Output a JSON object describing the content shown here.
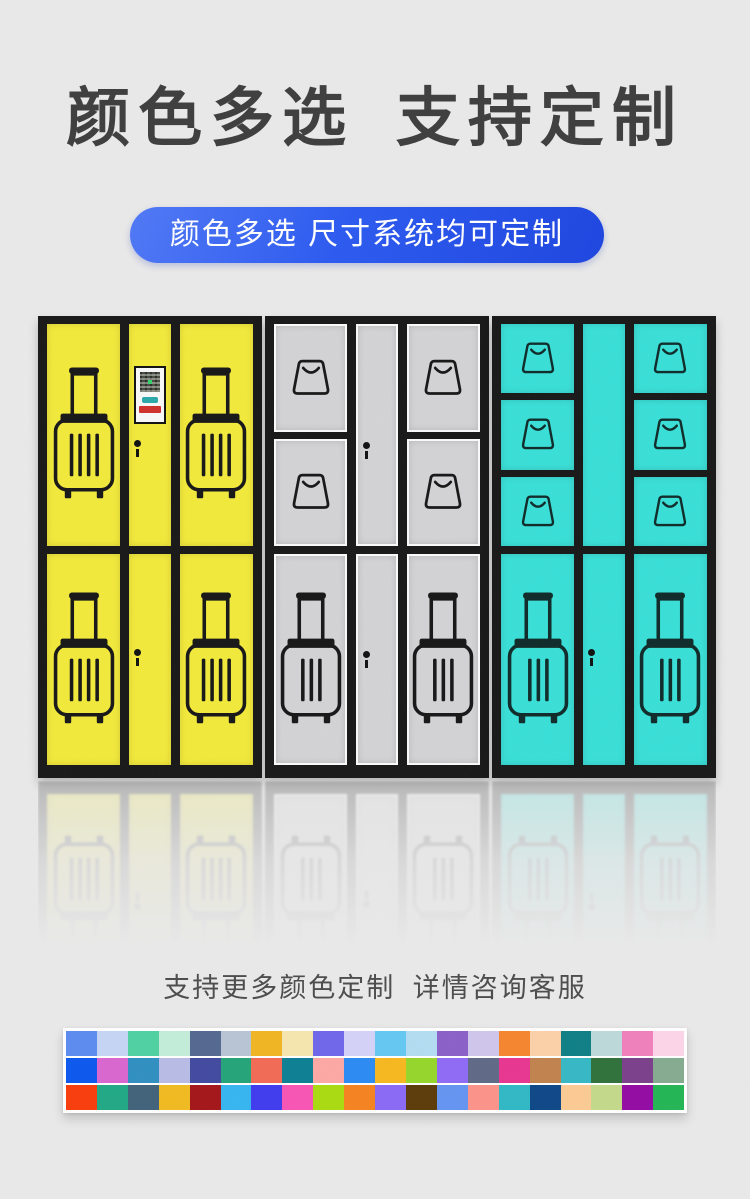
{
  "page": {
    "background_color": "#e9e9e9",
    "title": "颜色多选 支持定制",
    "title_color": "#3d3d3d",
    "banner": {
      "text": "颜色多选 尺寸系统均可定制",
      "bg_color": "#2b59f0",
      "text_color": "#ffffff"
    },
    "footer_note": "支持更多颜色定制 详情咨询客服"
  },
  "locker_frame_color": "#171717",
  "keyhole_color": "#101010",
  "screen": {
    "panel_bg": "#f8f8f8",
    "border_color": "#101010",
    "qr_icon": "qr-code",
    "qr_color": "#474c41",
    "teal_button_color": "#2aa8a8",
    "red_label_color": "#cf2f2c"
  },
  "lockers": [
    {
      "id": "yellow",
      "door_color": "#f2e93a",
      "icon_color": "#161616",
      "door_border": "",
      "top_compartments": 1,
      "top_icon": "luggage",
      "bottom_icon": "luggage",
      "luggage_slats": 4,
      "bag_size": 46,
      "has_screen": true,
      "keyhole_top": true,
      "keyhole_bottom": true
    },
    {
      "id": "gray",
      "door_color": "#d3d3d5",
      "icon_color": "#161616",
      "door_border": "#fafafa",
      "top_compartments": 2,
      "top_icon": "bag",
      "bottom_icon": "luggage",
      "luggage_slats": 3,
      "bag_size": 46,
      "has_screen": false,
      "keyhole_top": true,
      "keyhole_bottom": true
    },
    {
      "id": "cyan",
      "door_color": "#38dfd7",
      "icon_color": "#0e2a28",
      "door_border": "",
      "top_compartments": 3,
      "top_icon": "bag",
      "bottom_icon": "luggage",
      "luggage_slats": 3,
      "bag_size": 40,
      "has_screen": false,
      "keyhole_top": false,
      "keyhole_bottom": true
    }
  ],
  "palette": {
    "rows": [
      [
        "#5b8bf0",
        "#c5d5f4",
        "#4ed1a1",
        "#c2ecd9",
        "#53688f",
        "#b8c3d4",
        "#f0b521",
        "#f5e5ad",
        "#6f66ea",
        "#d4d2f7",
        "#63c8f2",
        "#b3dcf2",
        "#8a5fc8",
        "#cfc5ec",
        "#f5852e",
        "#fbd0a8",
        "#0d7f85",
        "#bcd9d9",
        "#f07fbc",
        "#fcd4e8"
      ],
      [
        "#0b57ee",
        "#d966cf",
        "#2f8fc0",
        "#b8bce5",
        "#41499f",
        "#23a378",
        "#f26a54",
        "#0c7f93",
        "#fda8a3",
        "#2b8af2",
        "#f7b81e",
        "#94d629",
        "#8f6af5",
        "#5f6986",
        "#e83590",
        "#c0824d",
        "#35b8c4",
        "#2f7039",
        "#7a3f8a",
        "#84ab8f"
      ],
      [
        "#f93c0c",
        "#20a884",
        "#41617a",
        "#f0ba1f",
        "#a31518",
        "#35b5f0",
        "#3f3aee",
        "#f854b5",
        "#aadb0f",
        "#f5831f",
        "#8a68f5",
        "#5c3a08",
        "#6494f2",
        "#fb938a",
        "#2fb8c4",
        "#0d4687",
        "#fcca93",
        "#c4d98a",
        "#930aa3",
        "#23b554"
      ]
    ]
  }
}
